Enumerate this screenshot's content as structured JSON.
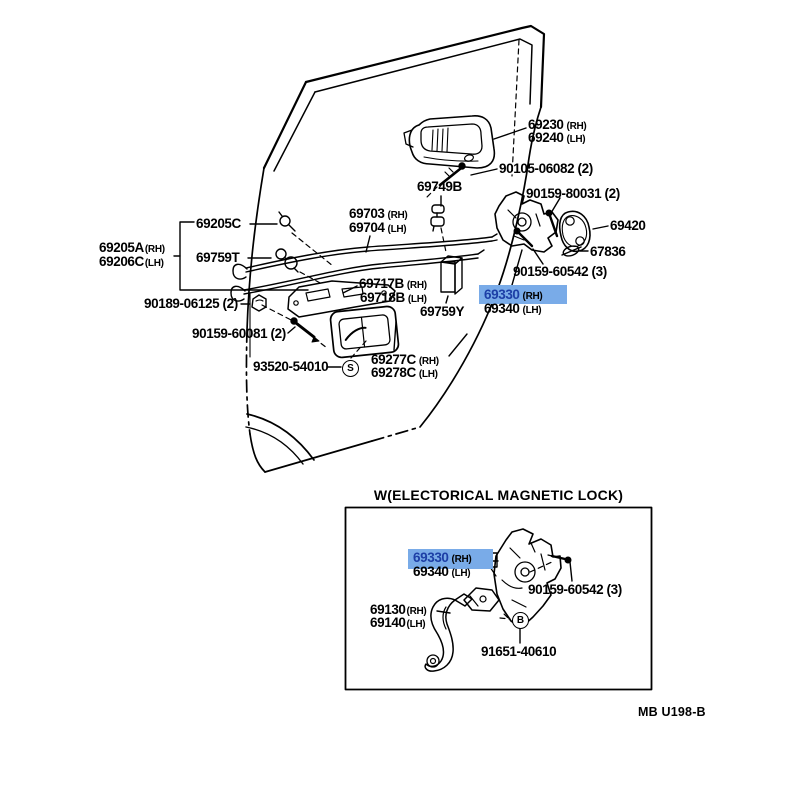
{
  "page": {
    "background": "#ffffff"
  },
  "colors": {
    "highlight_bg": "#79abe8",
    "highlight_num": "#1d3fa6",
    "ink": "#000000"
  },
  "inset": {
    "title": "W(ELECTORICAL MAGNETIC LOCK)"
  },
  "footer": {
    "code": "MB U198-B"
  },
  "markers": {
    "s": "S",
    "b": "B"
  },
  "labels": {
    "p69230": {
      "num": "69230",
      "side": "(RH)"
    },
    "p69240": {
      "num": "69240",
      "side": "(LH)"
    },
    "p90105": "90105-06082 (2)",
    "p69749B": "69749B",
    "p80031": "90159-80031 (2)",
    "p69420": "69420",
    "p67836": "67836",
    "p60542": "90159-60542 (3)",
    "p69205C": "69205C",
    "p69205A": {
      "num": "69205A",
      "side": "(RH)"
    },
    "p69206C": {
      "num": "69206C",
      "side": "(LH)"
    },
    "p69759T": "69759T",
    "p69703": {
      "num": "69703",
      "side": "(RH)"
    },
    "p69704": {
      "num": "69704",
      "side": "(LH)"
    },
    "p90189": "90189-06125 (2)",
    "p60081": "90159-60081 (2)",
    "p69717B": {
      "num": "69717B",
      "side": "(RH)"
    },
    "p69718B": {
      "num": "69718B",
      "side": "(LH)"
    },
    "p69759Y": "69759Y",
    "p69330": {
      "num": "69330",
      "side": "(RH)"
    },
    "p69340": {
      "num": "69340",
      "side": "(LH)"
    },
    "p93520": "93520-54010",
    "p69277C": {
      "num": "69277C",
      "side": "(RH)"
    },
    "p69278C": {
      "num": "69278C",
      "side": "(LH)"
    },
    "i69330": {
      "num": "69330",
      "side": "(RH)"
    },
    "i69340": {
      "num": "69340",
      "side": "(LH)"
    },
    "i60542": "90159-60542 (3)",
    "i69130": {
      "num": "69130",
      "side": "(RH)"
    },
    "i69140": {
      "num": "69140",
      "side": "(LH)"
    },
    "i91651": "91651-40610"
  }
}
